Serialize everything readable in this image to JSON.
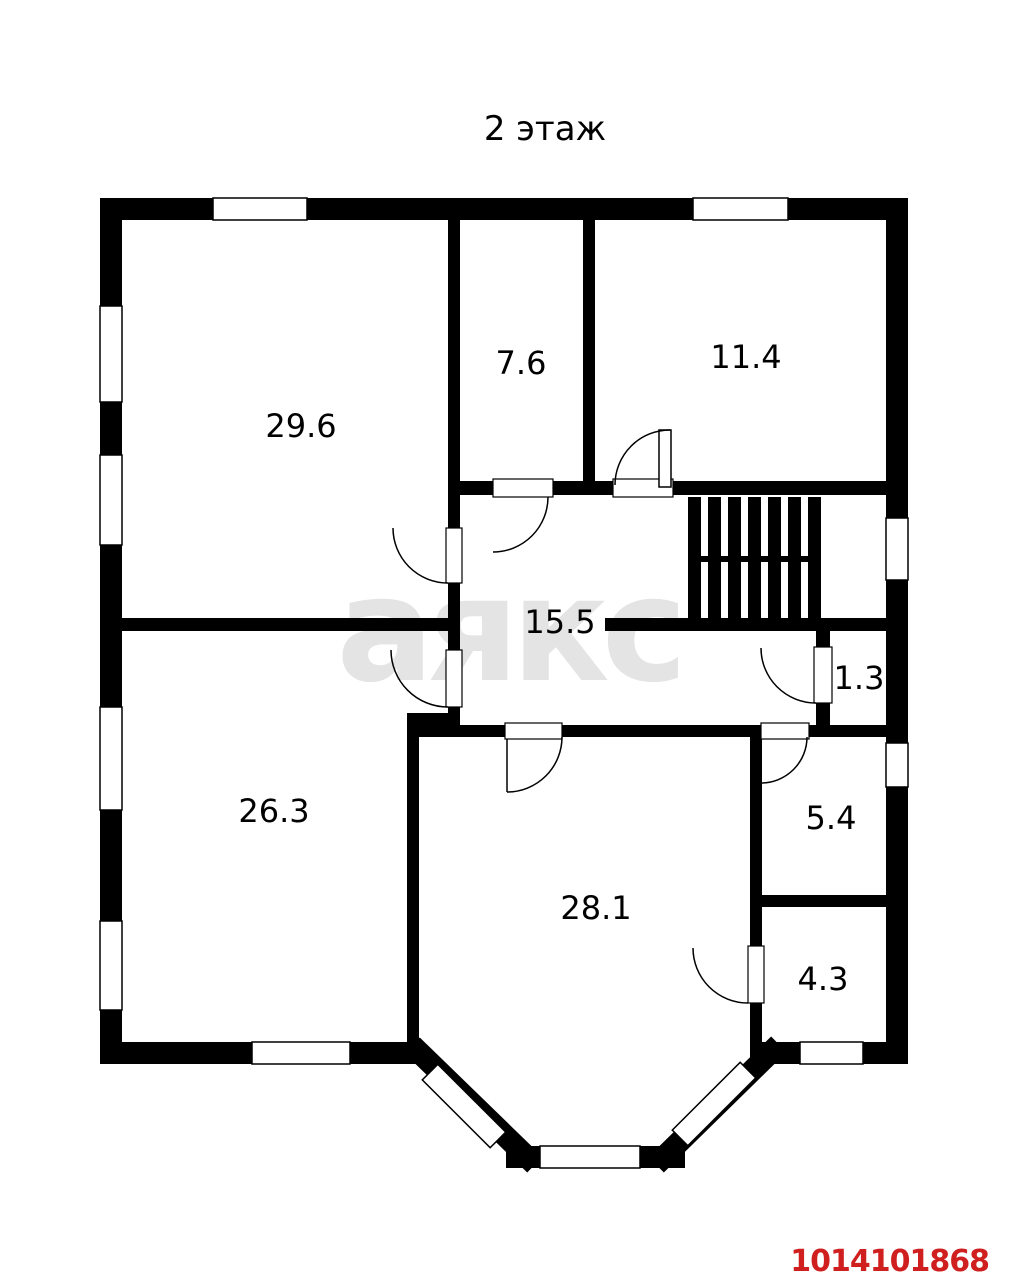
{
  "page": {
    "title": "2 этаж",
    "watermark": "аякс",
    "listing_id": "1014101868"
  },
  "colors": {
    "background": "#ffffff",
    "walls": "#000000",
    "watermark": "#e4e4e4",
    "listing_id": "#d01f1f"
  },
  "floor_plan": {
    "floor_label": "2 этаж",
    "rooms": [
      {
        "id": "room-29-6",
        "area": "29.6"
      },
      {
        "id": "room-7-6",
        "area": "7.6"
      },
      {
        "id": "room-11-4",
        "area": "11.4"
      },
      {
        "id": "hall-15-5",
        "area": "15.5"
      },
      {
        "id": "closet-1-3",
        "area": "1.3"
      },
      {
        "id": "room-26-3",
        "area": "26.3"
      },
      {
        "id": "room-5-4",
        "area": "5.4"
      },
      {
        "id": "room-28-1",
        "area": "28.1"
      },
      {
        "id": "room-4-3",
        "area": "4.3"
      }
    ]
  }
}
